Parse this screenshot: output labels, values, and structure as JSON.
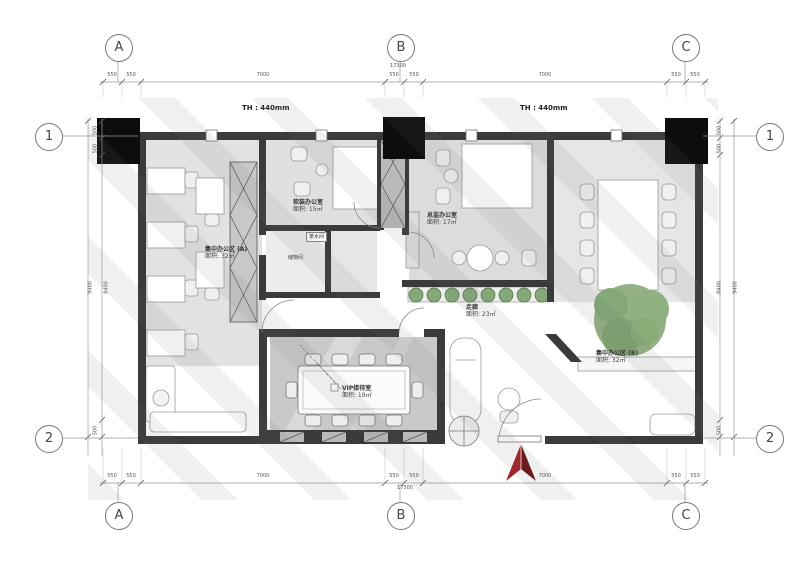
{
  "grid": {
    "columns": [
      "A",
      "B",
      "C"
    ],
    "rows": [
      "1",
      "2"
    ]
  },
  "dims": {
    "top": {
      "segs": [
        "550",
        "550",
        "7000",
        "550",
        "550",
        "7000",
        "550",
        "550"
      ],
      "total": "17300"
    },
    "bottom": {
      "segs": [
        "550",
        "550",
        "7000",
        "550",
        "550",
        "7000",
        "550",
        "550"
      ],
      "total": "17300"
    },
    "left": {
      "segs": [
        "500",
        "500",
        "8400",
        "500"
      ],
      "total": "9400"
    },
    "right": {
      "segs": [
        "500",
        "500",
        "8400",
        "500"
      ],
      "total": "9400"
    }
  },
  "annotations": {
    "th_left": "TH : 440mm",
    "th_right": "TH : 440mm",
    "tea_room": "茶水间",
    "storage": "储物间"
  },
  "rooms": {
    "office_a": {
      "name": "集中办公区 (A)",
      "area": "面积: 32㎡"
    },
    "soft_office": {
      "name": "软装办公室",
      "area": "面积: 15㎡"
    },
    "director": {
      "name": "总监办公室",
      "area": "面积: 17㎡"
    },
    "corridor": {
      "name": "走廊",
      "area": "面积: 23㎡"
    },
    "office_b": {
      "name": "集中办公区 (B)",
      "area": "面积: 32㎡"
    },
    "vip": {
      "name": "VIP接待室",
      "area": "面积: 19㎡"
    }
  },
  "colors": {
    "wall": "#3a3a3a",
    "column": "#0d0d0d",
    "floor": "#e3e3e3",
    "plant_green": "#85a878",
    "tree_green": "#93b183",
    "north_arrow_red": "#8e1b1e",
    "dim_text": "#555555"
  }
}
